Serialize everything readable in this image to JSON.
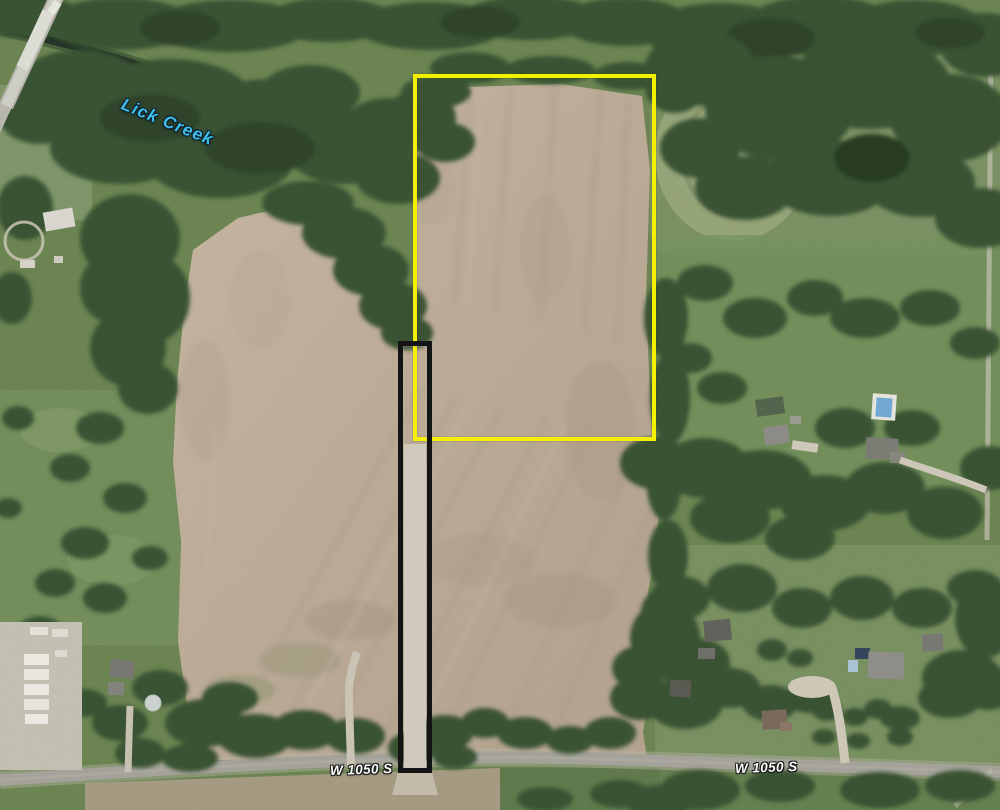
{
  "view": {
    "type": "satellite-map",
    "width_px": 1000,
    "height_px": 810,
    "scene": "Aerial imagery of farmland with two surveyed parcel outlines along W 1050 S and Lick Creek woodland to the northwest"
  },
  "labels": {
    "creek": {
      "text": "Lick Creek",
      "feature": "waterway",
      "color": "#3fbfe8"
    },
    "road_left": {
      "text": "W 1050 S",
      "feature": "road",
      "color": "#fbfbf9"
    },
    "road_right": {
      "text": "W 1050 S",
      "feature": "road",
      "color": "#fbfbf9"
    }
  },
  "overlays": {
    "parcel": {
      "name": "Main parcel boundary",
      "outline_color": "#f3f000",
      "shape": "rectangle"
    },
    "access_strip": {
      "name": "Access strip boundary",
      "outline_color": "#141414",
      "shape": "narrow vertical rectangle"
    }
  },
  "terrain_colors": {
    "tilled_field": "#bcab96",
    "grass": "#69834f",
    "tree_cover": "#34502e",
    "road": "#a3a198"
  }
}
